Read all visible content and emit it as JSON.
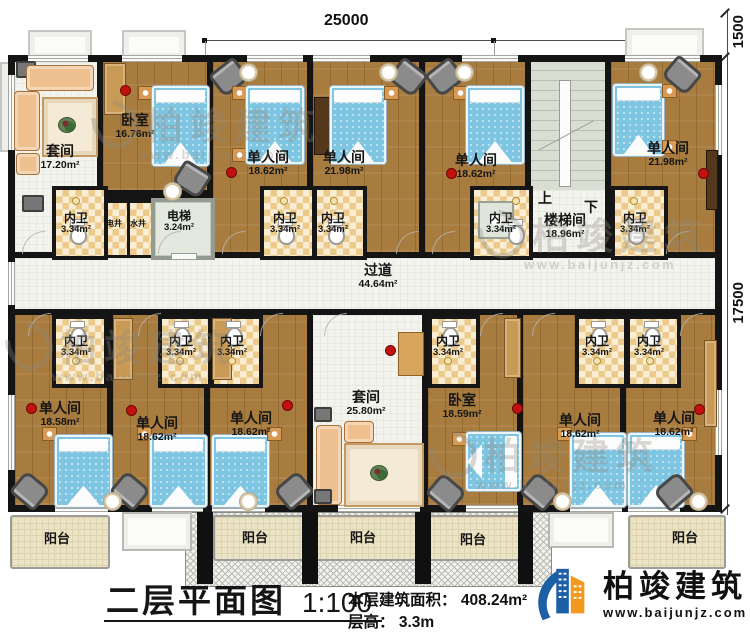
{
  "dimensions": {
    "top": "25000",
    "right_top": "1500",
    "right_side": "17500"
  },
  "rooms": {
    "suite_top": {
      "name": "套间",
      "area": "17.20m²"
    },
    "bedroom_top": {
      "name": "卧室",
      "area": "16.76m²"
    },
    "single_c": {
      "name": "单人间",
      "area": "18.62m²"
    },
    "single_d": {
      "name": "单人间",
      "area": "21.98m²"
    },
    "single_e": {
      "name": "单人间",
      "area": "18.62m²"
    },
    "single_g": {
      "name": "单人间",
      "area": "21.98m²"
    },
    "stairwell": {
      "name": "楼梯间",
      "area": "18.96m²",
      "up": "上",
      "down": "下"
    },
    "corridor": {
      "name": "过道",
      "area": "44.64m²"
    },
    "elevator": {
      "name": "电梯",
      "area": "3.24m²"
    },
    "shaft_electric": {
      "name": "电井"
    },
    "shaft_water": {
      "name": "水井"
    },
    "wc": {
      "name": "内卫",
      "area": "3.34m²"
    },
    "single_h": {
      "name": "单人间",
      "area": "18.58m²"
    },
    "single_i": {
      "name": "单人间",
      "area": "18.62m²"
    },
    "single_j": {
      "name": "单人间",
      "area": "18.62m²"
    },
    "suite_bottom": {
      "name": "套间",
      "area": "25.80m²"
    },
    "bedroom_bottom": {
      "name": "卧室",
      "area": "18.59m²"
    },
    "single_m": {
      "name": "单人间",
      "area": "18.62m²"
    },
    "single_n": {
      "name": "单人间",
      "area": "18.62m²"
    },
    "balcony": {
      "name": "阳台"
    }
  },
  "title": {
    "name": "二层平面图",
    "scale": "1:100",
    "area_label": "本层建筑面积：",
    "area_value": "408.24m²",
    "floor_height_label": "层高：",
    "floor_height_value": "3.3m"
  },
  "brand": {
    "name": "柏竣建筑",
    "website": "www.baijunjz.com"
  },
  "watermark": {
    "text": "柏竣建筑",
    "url": "www.baijunjz.com"
  },
  "colors": {
    "wood": "#a87c3e",
    "wall": "#141414",
    "bed": "#7ec5e2",
    "checker": "#ecca8b",
    "corridor": "#f4f4ef",
    "balcony": "#ebe3c6",
    "stairs": "#d8dfd2",
    "accent_red": "#c11210",
    "logo_blue": "#1c5fa5",
    "logo_orange": "#f29a1d"
  }
}
